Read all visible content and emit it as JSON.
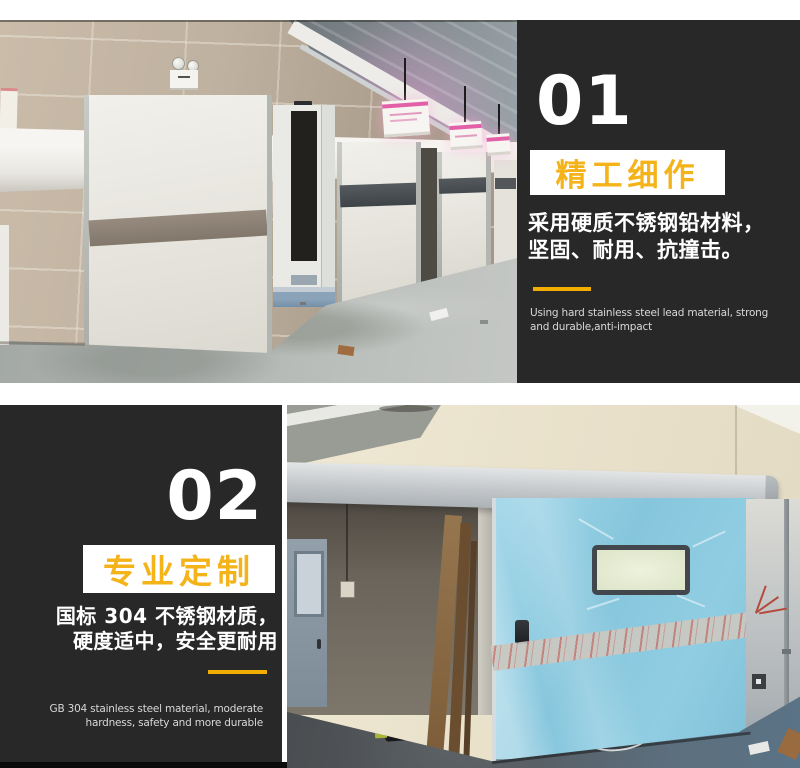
{
  "colors": {
    "panel_black": "#282828",
    "accent_yellow": "#f5b31a",
    "underline_yellow": "#f2ae00",
    "body_text": "#ffffff",
    "caption_text": "#d8d8d8",
    "door_blue": "#86c6dd"
  },
  "sections": [
    {
      "number": "01",
      "title": "精工细作",
      "body_lines": [
        "采用硬质不锈钢铅材料，",
        "坚固、耐用、抗撞击。"
      ],
      "caption_en": "Using hard stainless steel lead material, strong and durable,anti-impact"
    },
    {
      "number": "02",
      "title": "专业定制",
      "body_lines": [
        "国标 304 不锈钢材质，",
        "硬度适中，安全更耐用"
      ],
      "caption_en": "GB 304 stainless steel material, moderate hardness, safety and more durable"
    }
  ]
}
